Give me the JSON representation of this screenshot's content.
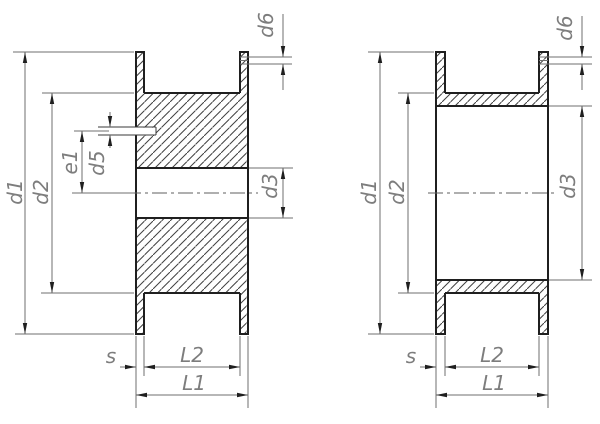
{
  "diagram": {
    "description": "Two flanged pulley cross-section views with dimension callouts",
    "background_color": "#ffffff",
    "outline_color": "#1f1f1f",
    "thin_line_color": "#6f6f6f",
    "hatch_color": "#404040",
    "label_color": "#7d7d7d",
    "views": [
      {
        "name": "solid-pulley-with-setscrew-section",
        "labels": {
          "d1": "d1",
          "d2": "d2",
          "e1": "e1",
          "d5": "d5",
          "d3": "d3",
          "d6": "d6",
          "s": "s",
          "L2": "L2",
          "L1": "L1"
        }
      },
      {
        "name": "thin-wall-pulley-section",
        "labels": {
          "d1": "d1",
          "d2": "d2",
          "d3": "d3",
          "d6": "d6",
          "s": "s",
          "L2": "L2",
          "L1": "L1"
        }
      }
    ]
  }
}
